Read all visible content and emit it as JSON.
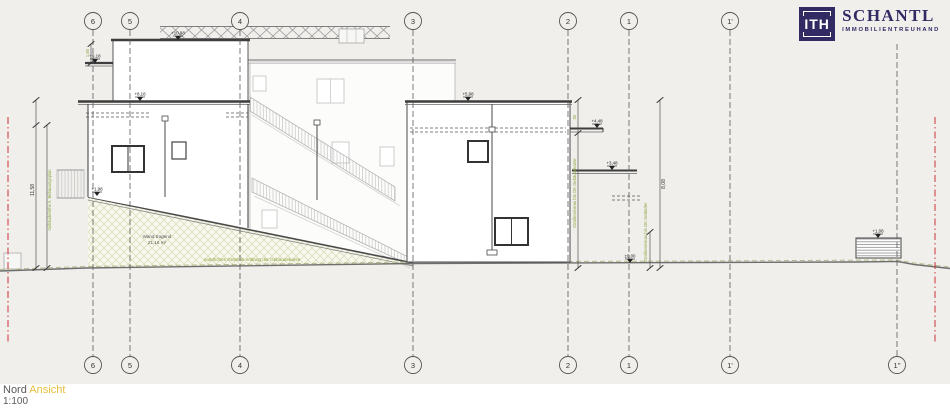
{
  "logo": {
    "monogram": "ITH",
    "name": "SCHANTL",
    "subtitle": "IMMOBILIENTREUHAND",
    "brand_color": "#312a63"
  },
  "title": {
    "view_primary": "Nord",
    "view_secondary": "Ansicht",
    "scale": "1:100"
  },
  "grid": {
    "top": [
      "6",
      "5",
      "4",
      "3",
      "2",
      "1",
      "1'"
    ],
    "bottom": [
      "6",
      "5",
      "4",
      "3",
      "2",
      "1",
      "1'",
      "1''"
    ]
  },
  "markers": [
    {
      "label": "+10,98"
    },
    {
      "label": "+9,18"
    },
    {
      "label": "+8,18"
    },
    {
      "label": "+5,98"
    },
    {
      "label": "+4,48"
    },
    {
      "label": "+3,48"
    },
    {
      "label": "±0,00"
    },
    {
      "label": "+1,98"
    },
    {
      "label": "+1,08"
    }
  ],
  "dimensions": {
    "left_total": "11,58",
    "left_top": "1,80",
    "left_note": "Gebäudehöhe lt. Bebauungsplan",
    "right_top": "50",
    "right_total": "8,08",
    "right_note": "Straßenniveau bis OK Gebäudekante",
    "right_note2": "Straßenniveau bis OK Geländer"
  },
  "notes": {
    "wall_line1": "Wand tragend",
    "wall_line2": "21,16 m²",
    "terrain": "natürliches Gelände entlang der Gebäudekante"
  },
  "colors": {
    "sheet_background": "#f0efec",
    "drawing_ink": "#4a4a4a",
    "annotation_green": "#8ba33c",
    "boundary_red": "#cc3333"
  }
}
